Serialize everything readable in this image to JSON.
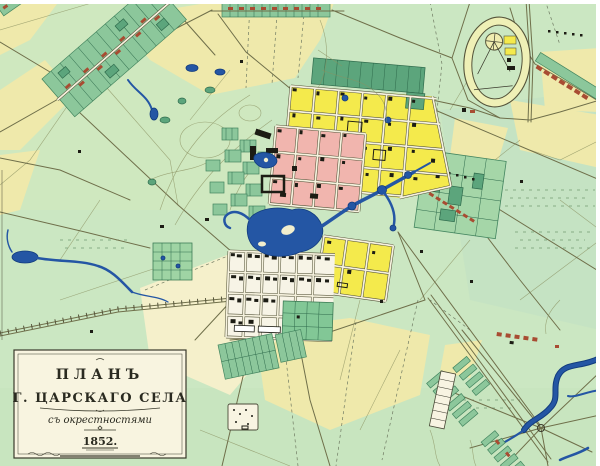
{
  "cartouche": {
    "line1": "ПЛАНЪ",
    "line2": "Г. ЦАРСКАГО СЕЛА",
    "line3": "съ окрестностями",
    "year": "1852."
  },
  "colors": {
    "paper": "#ffffff",
    "field_green": "#cbe7c2",
    "field_green_dark": "#b9ddc6",
    "field_yellow": "#efe9ab",
    "field_cream": "#f5f0cb",
    "block_yellow": "#f4ea4c",
    "block_pink": "#f1b5ae",
    "parcel_green": "#8cc79b",
    "parcel_green_dark": "#5ca57c",
    "water": "#2456a4",
    "water_dark": "#123c7e",
    "road": "#6f6f4a",
    "building_black": "#1c1c14",
    "building_red": "#a84c32",
    "cartouche_bg": "#f8f4e0",
    "ink": "#2a2a20"
  }
}
